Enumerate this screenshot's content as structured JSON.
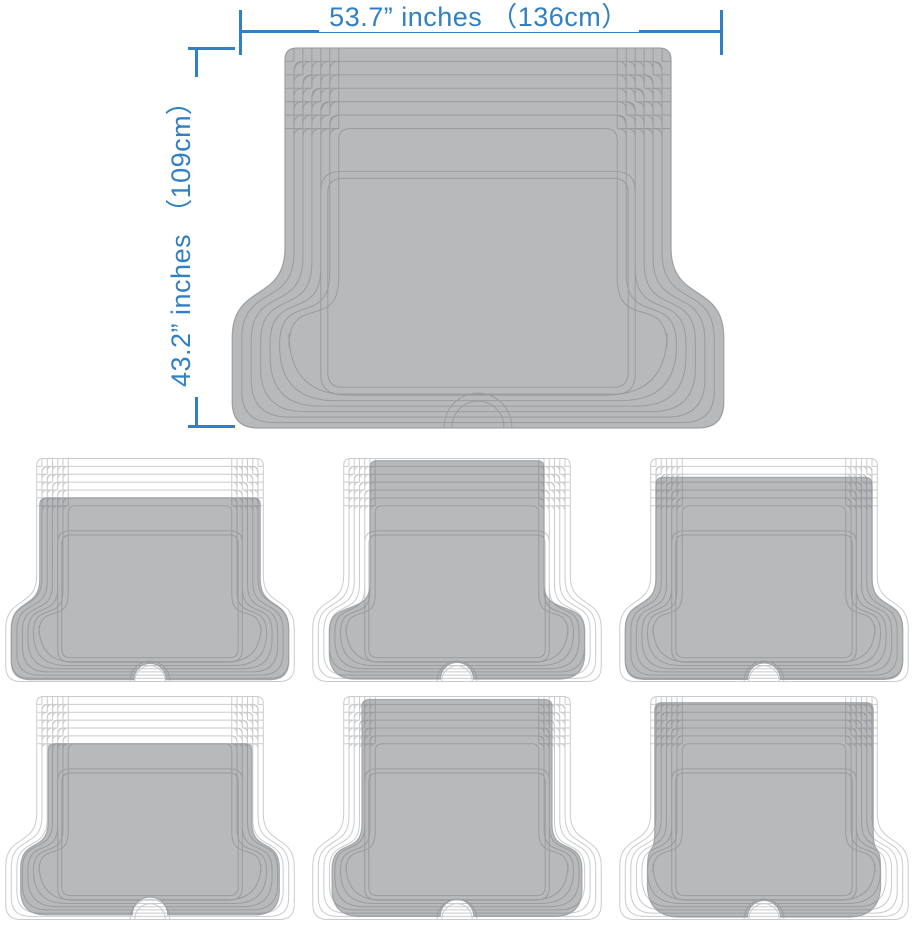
{
  "page": {
    "background": "#ffffff",
    "description": "Trim-to-fit cargo trunk mat dimension diagram with six trim variants"
  },
  "dimensions": {
    "width_label": "53.7” inches （136cm）",
    "height_label": "43.2” inches （109cm）",
    "accent_color": "#3180c4"
  },
  "mat": {
    "fill_color": "#b8b9bb",
    "line_color": "#9a9da0",
    "edge_color": "#a4a7aa",
    "ghost_line_color": "#c9cbcd",
    "trim_levels": 7,
    "main": {
      "name": "full-size-cargo-mat",
      "trim": {
        "top": 0,
        "side": 0,
        "wing": 0,
        "bottom": 0
      },
      "notch": false
    },
    "variants": [
      {
        "name": "trim-top-depth",
        "trim": {
          "top": 5,
          "side": 0.6,
          "wing": 1,
          "bottom": 0.6
        },
        "notch": true
      },
      {
        "name": "trim-tongue-width",
        "trim": {
          "top": 0.3,
          "side": 5,
          "wing": 3,
          "bottom": 0.8
        },
        "notch": true
      },
      {
        "name": "trim-slight-top",
        "trim": {
          "top": 2.4,
          "side": 1,
          "wing": 1,
          "bottom": 0.7
        },
        "notch": true
      },
      {
        "name": "trim-all-around",
        "trim": {
          "top": 6,
          "side": 2.2,
          "wing": 2.7,
          "bottom": 1.5
        },
        "notch": true
      },
      {
        "name": "trim-width-full-depth",
        "trim": {
          "top": 0.4,
          "side": 3.5,
          "wing": 3.5,
          "bottom": 1.0
        },
        "notch": true
      },
      {
        "name": "trim-side-wings",
        "trim": {
          "top": 0.8,
          "side": 0.8,
          "wing": 5,
          "bottom": 0.8
        },
        "notch": true
      }
    ],
    "grid": {
      "column_lefts": [
        4,
        311,
        618
      ],
      "row_tops": [
        456,
        694
      ],
      "cell_width": 292,
      "cell_height": 228
    }
  }
}
